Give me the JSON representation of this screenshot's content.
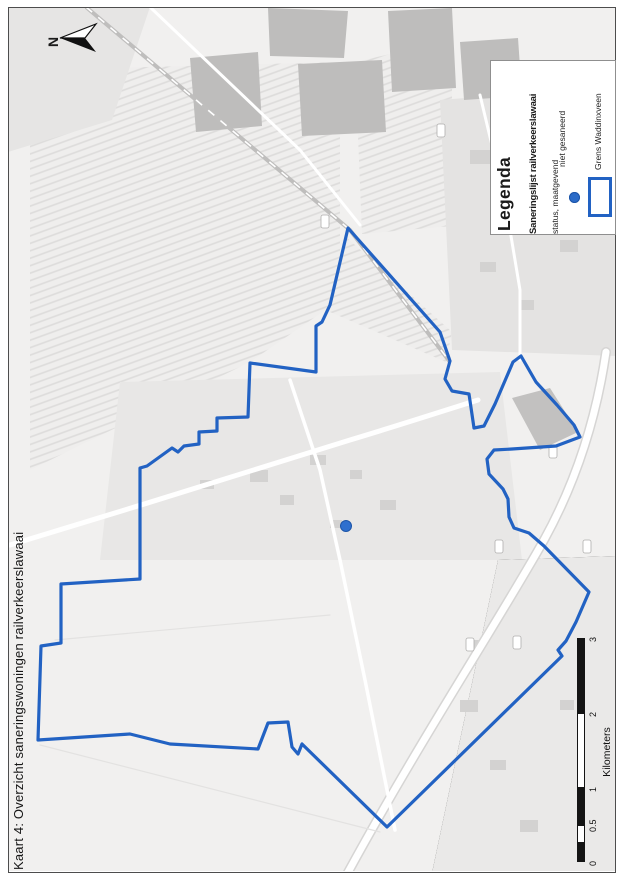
{
  "page_title": "Kaart 4: Overzicht saneringswoningen railverkeerslawaai",
  "north": {
    "label": "N"
  },
  "legend": {
    "title": "Legenda",
    "subtitle": "Saneringslijst railverkeerslawaai",
    "status_line": "status, maatgevend",
    "items": [
      {
        "symbol": "point",
        "label": "niet gesaneerd",
        "color": "#2b6bc8"
      },
      {
        "symbol": "rectangle-outline",
        "label": "Grens Waddinxveen",
        "color": "#2262c3"
      }
    ]
  },
  "scalebar": {
    "ticks": [
      "0",
      "0.5",
      "1",
      "2",
      "3"
    ],
    "unit": "Kilometers"
  },
  "map": {
    "boundary_color": "#2262c3",
    "boundary_points": "348,228 440,332 450,361 445,379 452,391 469,394 474,428 484,426 495,404 513,362 521,356 536,382 557,405 574,425 580,437 556,446 512,449 494,450 487,459 489,474 503,489 508,499 509,517 514,528 529,533 544,546 589,592 576,622 566,641 558,650 562,656 387,827 302,744 298,754 292,747 288,722 268,723 258,749 170,744 130,734 38,740 41,646 61,643 61,584 140,579 140,468 147,466 172,448 178,452 184,446 199,444 199,432 217,431 217,418 248,417 250,363 316,372 316,326 322,322 330,305",
    "marker": {
      "x": 346,
      "y": 526,
      "color": "#2e6fce"
    }
  }
}
